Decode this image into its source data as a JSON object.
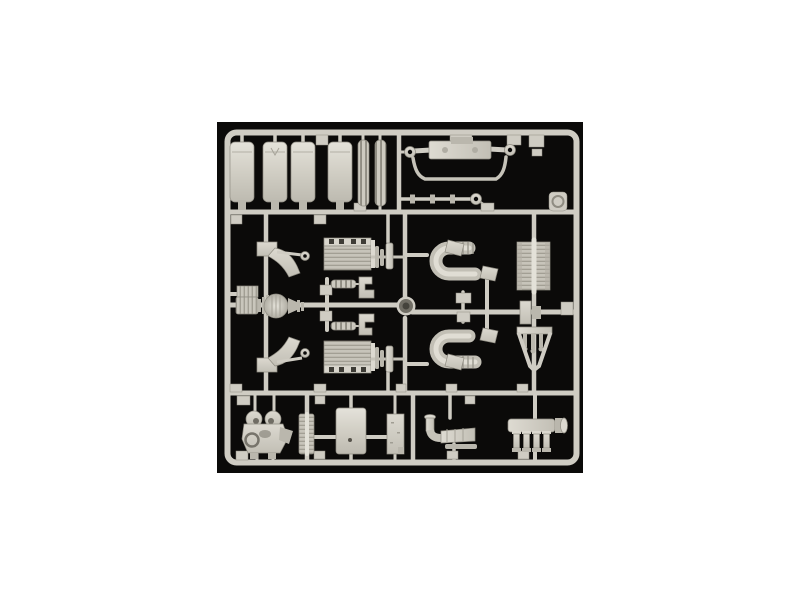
{
  "page": {
    "kind": "product-photo-on-white"
  },
  "colors": {
    "page_bg": "#ffffff",
    "photo_bg": "#0b0a09",
    "plastic": "#cfccc3",
    "plastic_light": "#e3e1d8",
    "plastic_mid": "#bab7ad",
    "plastic_shadow": "#8f8c82",
    "detail_dark": "#3e3c36"
  },
  "photo": {
    "subject": "model-kit-sprue",
    "plastic_finish": "light-gray",
    "background": "black",
    "parts": [
      {
        "name": "fuel-tank",
        "count": 4
      },
      {
        "name": "leaf-spring-strip",
        "count": 2
      },
      {
        "name": "front-axle-with-sway-bar",
        "count": 1
      },
      {
        "name": "tie-rod",
        "count": 1
      },
      {
        "name": "axle-bracket",
        "count": 2
      },
      {
        "name": "differential-housing",
        "count": 1
      },
      {
        "name": "engine-block-half",
        "count": 2
      },
      {
        "name": "coil-spring",
        "count": 2
      },
      {
        "name": "spring-bracket",
        "count": 2
      },
      {
        "name": "u-shaped-exhaust-pipe",
        "count": 2
      },
      {
        "name": "wedge-bracket",
        "count": 4
      },
      {
        "name": "radiator-core",
        "count": 1
      },
      {
        "name": "claw-hanger",
        "count": 1
      },
      {
        "name": "compressor-unit",
        "count": 1
      },
      {
        "name": "ribbed-strip",
        "count": 1
      },
      {
        "name": "panel-plate",
        "count": 1
      },
      {
        "name": "side-plate",
        "count": 1
      },
      {
        "name": "muffler-with-elbow",
        "count": 1
      },
      {
        "name": "intake-manifold",
        "count": 1
      },
      {
        "name": "round-cap-part",
        "count": 1
      },
      {
        "name": "sprue-gate-tab",
        "count": 18
      }
    ]
  }
}
